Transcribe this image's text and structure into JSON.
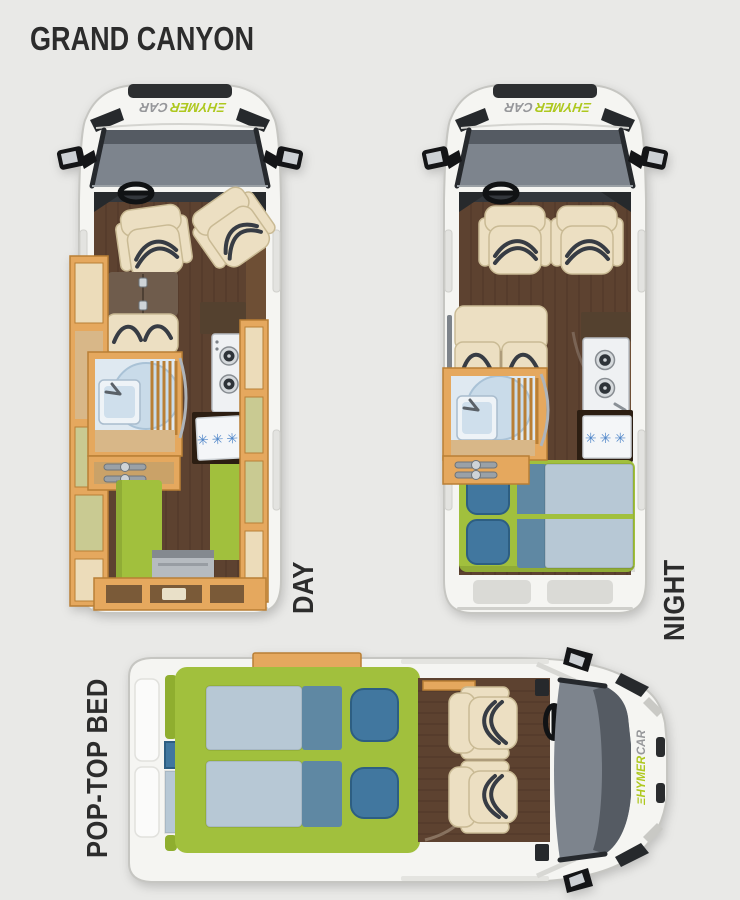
{
  "title": "GRAND CANYON",
  "brand": {
    "green_part": "ΞHYMER",
    "gray_part": "CAR"
  },
  "views": {
    "day": {
      "label": "DAY"
    },
    "night": {
      "label": "NIGHT"
    },
    "poptop": {
      "label": "POP-TOP BED"
    }
  },
  "appliances": {
    "freezer_rating_symbols": "✳✳✳"
  },
  "colors": {
    "background": "#e9e9e7",
    "ink": "#2c2c2c",
    "body-white": "#f5f5f2",
    "body-outline": "#c6c6c2",
    "windshield": "#7d848d",
    "windshield-dark": "#555b63",
    "wood-floor": "#5d4230",
    "cabinet-wood": "#e5a85e",
    "cabinet-wood-dark": "#b97f35",
    "cabinet-panel": "#ecdcba",
    "cabinet-tan": "#d8b788",
    "seat-cream": "#ecdfc2",
    "piping": "#373c44",
    "bench-brown": "#6f5c4c",
    "lime": "#a1c03d",
    "lime-pale": "#c9ca92",
    "pillow-blue": "#41779f",
    "pillow-blue-dark": "#2d5e82",
    "duvet-light": "#b7c8d5",
    "duvet-mid": "#5f88a3",
    "white-goods": "#eff1f3",
    "fridge-frame": "#2c1e12",
    "snowflake-blue": "#4f86c9",
    "logo-green": "#aec81e",
    "logo-gray": "#96979a"
  }
}
